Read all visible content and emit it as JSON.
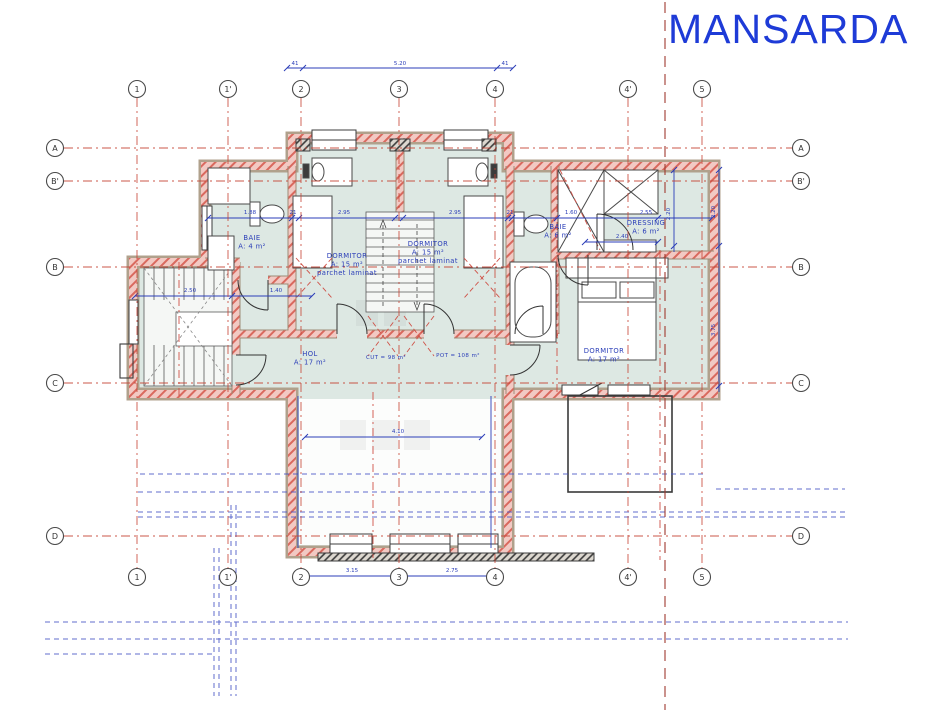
{
  "title": "MANSARDA",
  "colors": {
    "title_blue": "#1e3bd7",
    "dimension_blue": "#2b3eb8",
    "construction_blue": "#4452c6",
    "grid_axis_red": "#c64536",
    "wall_hatch_red": "#d9695e",
    "wall_tan": "#b0a18c",
    "floor_green": "#dde8e3"
  },
  "plan": {
    "grid": {
      "columns": [
        {
          "label": "1",
          "x": 137
        },
        {
          "label": "1'",
          "x": 228
        },
        {
          "label": "2",
          "x": 301
        },
        {
          "label": "3",
          "x": 399
        },
        {
          "label": "4",
          "x": 495
        },
        {
          "label": "4'",
          "x": 628
        },
        {
          "label": "5",
          "x": 702
        }
      ],
      "rows": [
        {
          "label": "A",
          "y": 148
        },
        {
          "label": "B'",
          "y": 181
        },
        {
          "label": "B",
          "y": 267
        },
        {
          "label": "C",
          "y": 383
        },
        {
          "label": "D",
          "y": 536
        }
      ]
    },
    "rooms": [
      {
        "id": "baie-mica",
        "x": 252,
        "y": 240,
        "lines": [
          "BAIE",
          "A: 4 m²"
        ]
      },
      {
        "id": "dormitor-stanga",
        "x": 347,
        "y": 258,
        "lines": [
          "DORMITOR",
          "A: 15 m²",
          "parchet laminat"
        ]
      },
      {
        "id": "dormitor-mijloc",
        "x": 428,
        "y": 246,
        "lines": [
          "DORMITOR",
          "A: 15 m²",
          "parchet laminat"
        ]
      },
      {
        "id": "baie-mare",
        "x": 558,
        "y": 229,
        "lines": [
          "BAIE",
          "A: 6 m²"
        ]
      },
      {
        "id": "dressing",
        "x": 646,
        "y": 225,
        "lines": [
          "DRESSING",
          "A: 6 m²"
        ]
      },
      {
        "id": "hol",
        "x": 310,
        "y": 356,
        "lines": [
          "HOL",
          "A: 17 m²"
        ]
      },
      {
        "id": "dormitor-matrimonial",
        "x": 604,
        "y": 353,
        "lines": [
          "DORMITOR",
          "A: 17 m²"
        ]
      },
      {
        "id": "indicator-cut",
        "x": 386,
        "y": 359,
        "lines": [
          "CUT = 98 m²"
        ],
        "size": 5.5
      },
      {
        "id": "indicator-pot",
        "x": 458,
        "y": 357,
        "lines": [
          "POT = 108 m²"
        ],
        "size": 5.5
      }
    ],
    "dimensions": [
      {
        "t": "41",
        "x": 295,
        "y": 65
      },
      {
        "t": "5.20",
        "x": 400,
        "y": 65
      },
      {
        "t": "41",
        "x": 505,
        "y": 65
      },
      {
        "t": "3.15",
        "x": 352,
        "y": 572
      },
      {
        "t": "2.75",
        "x": 452,
        "y": 572
      },
      {
        "t": "1.88",
        "x": 250,
        "y": 214
      },
      {
        "t": "21",
        "x": 293,
        "y": 214
      },
      {
        "t": "2.95",
        "x": 344,
        "y": 214
      },
      {
        "t": "2.95",
        "x": 455,
        "y": 214
      },
      {
        "t": "21",
        "x": 510,
        "y": 214
      },
      {
        "t": "1.60",
        "x": 571,
        "y": 214
      },
      {
        "t": "2.55",
        "x": 646,
        "y": 214
      },
      {
        "t": "2.40",
        "x": 622,
        "y": 238
      },
      {
        "t": "2.50",
        "x": 190,
        "y": 292
      },
      {
        "t": "1.40",
        "x": 276,
        "y": 292
      },
      {
        "t": "4.10",
        "x": 398,
        "y": 433
      },
      {
        "t": "2.20",
        "x": 670,
        "y": 214,
        "r": -90
      },
      {
        "t": "2.20",
        "x": 715,
        "y": 212,
        "r": -90
      },
      {
        "t": "3.75",
        "x": 715,
        "y": 330,
        "r": -90
      }
    ]
  }
}
